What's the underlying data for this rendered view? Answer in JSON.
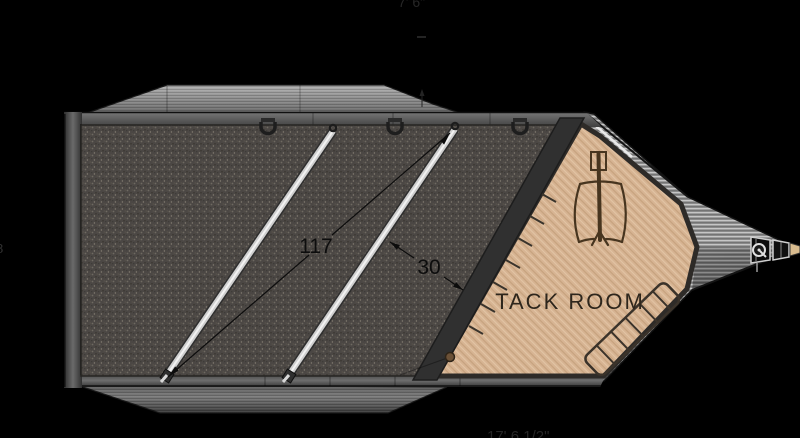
{
  "labels": {
    "tack_room": "TACK ROOM",
    "dim_stall_length": "117",
    "dim_stall_width": "30",
    "cropped_top_dim": "7' 6\"",
    "cropped_bottom_dim": "17' 6 1/2\"",
    "cropped_left_dim": "8"
  },
  "parts": {
    "stall_divider_count": 2,
    "tie_ring_count": 3,
    "blanket_bar_tick_count": 7,
    "rear_rack_rung_count": 5
  },
  "colors": {
    "background": "#000000",
    "floor_mat": "#4b4744",
    "wood_floor": "#d7b493",
    "metal_light": "#9a9a9a",
    "divider_bar": "#d9d9d9",
    "outline_dark": "#1a1a1a",
    "saddle_brown": "#47351f",
    "dim_text": "#0d0d0d",
    "label_text": "#2e261c"
  }
}
